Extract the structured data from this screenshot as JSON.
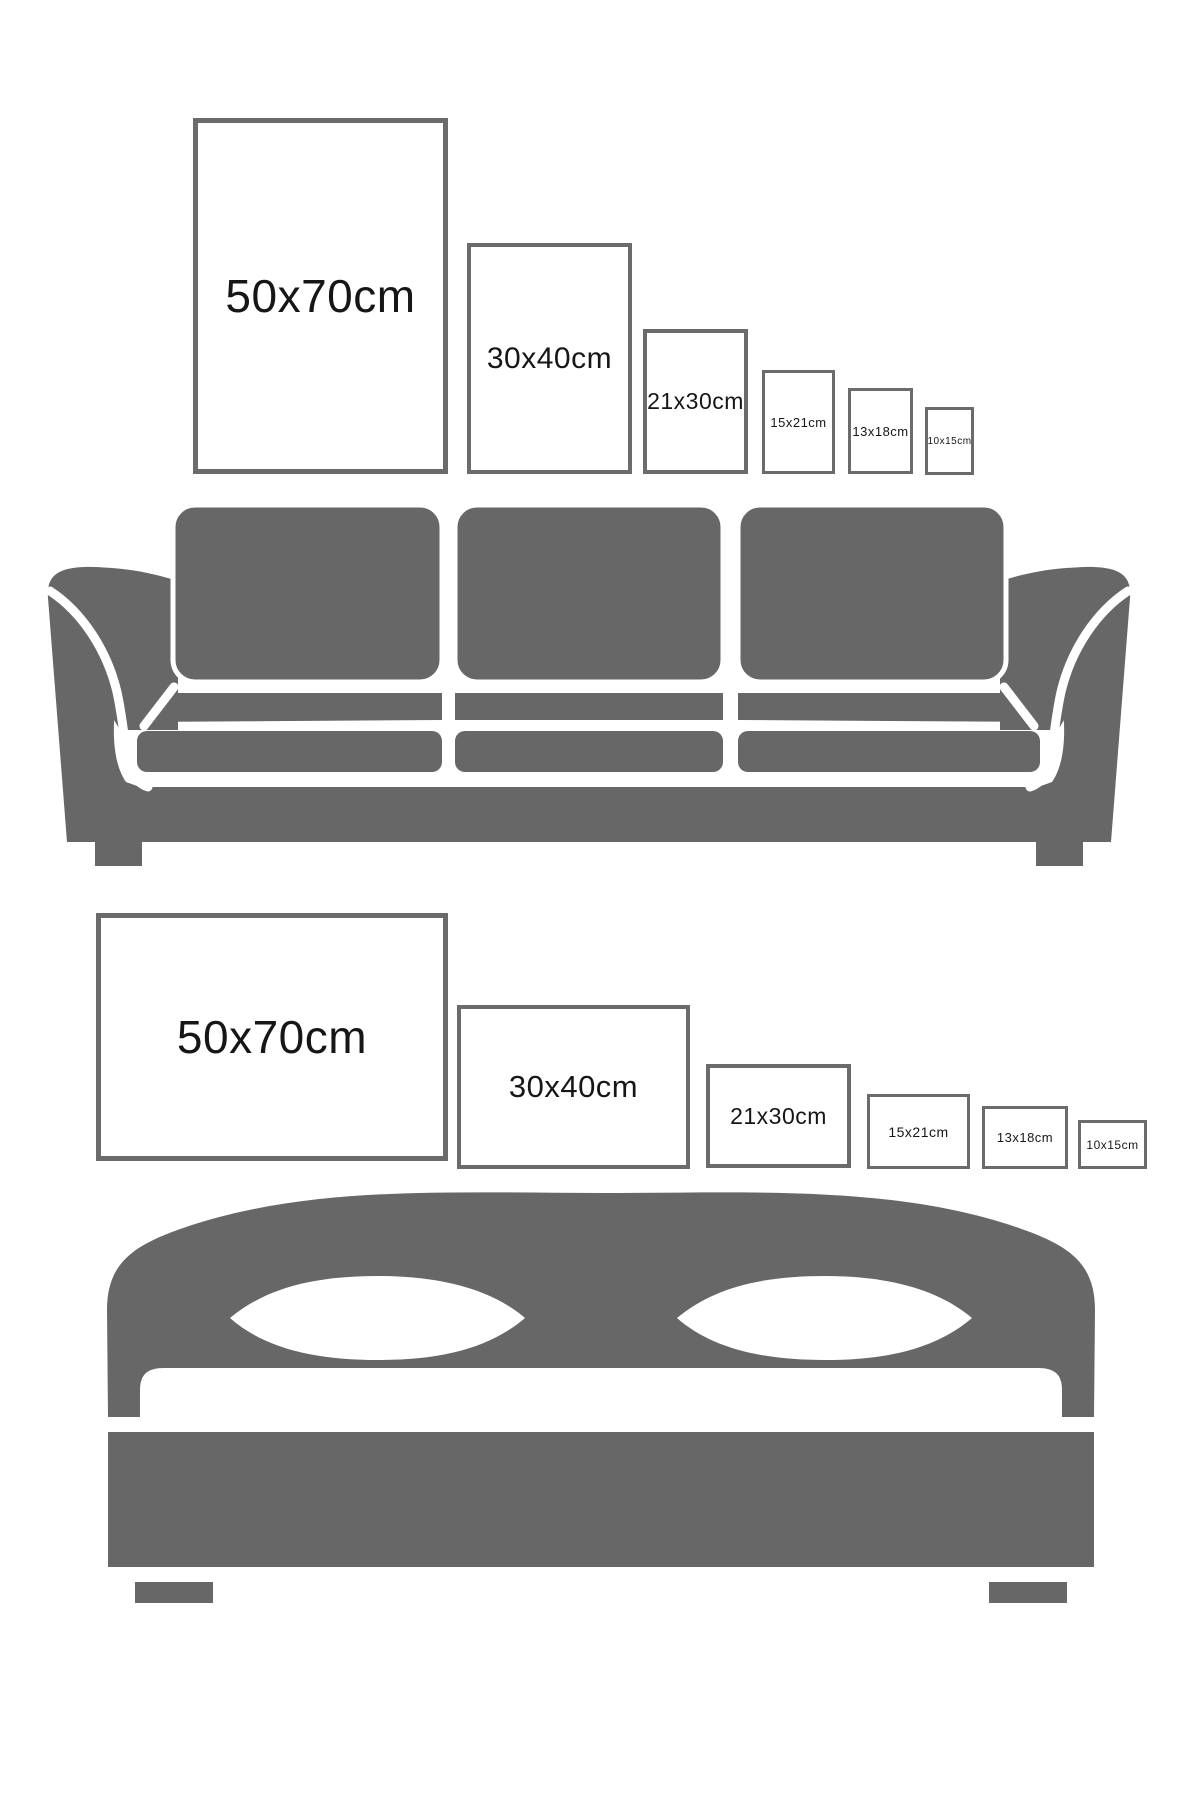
{
  "colors": {
    "background": "#ffffff",
    "furniture_gray": "#676767",
    "frame_border_gray": "#6b6b6b",
    "label_text": "#161616"
  },
  "size_guide": {
    "sofa_row": {
      "icon": "sofa-icon",
      "orientation": "portrait",
      "sizes": [
        {
          "label": "50x70cm"
        },
        {
          "label": "30x40cm"
        },
        {
          "label": "21x30cm"
        },
        {
          "label": "15x21cm"
        },
        {
          "label": "13x18cm"
        },
        {
          "label": "10x15cm"
        }
      ]
    },
    "bed_row": {
      "icon": "bed-icon",
      "orientation": "landscape",
      "sizes": [
        {
          "label": "50x70cm"
        },
        {
          "label": "30x40cm"
        },
        {
          "label": "21x30cm"
        },
        {
          "label": "15x21cm"
        },
        {
          "label": "13x18cm"
        },
        {
          "label": "10x15cm"
        }
      ]
    }
  }
}
